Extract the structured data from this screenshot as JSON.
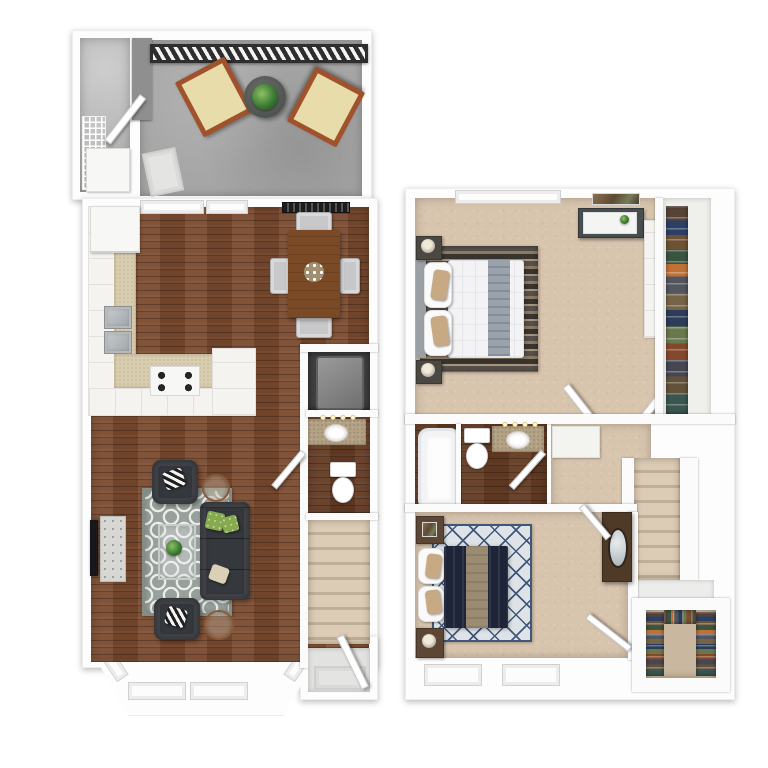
{
  "image_type": "3d-floor-plan-rendering",
  "floors": [
    {
      "label": "first-floor-plan",
      "rooms": [
        "patio",
        "storage-closet",
        "kitchen",
        "dining-area",
        "living-room",
        "utility-closet",
        "powder-room",
        "staircase",
        "entry",
        "bay-window"
      ],
      "furniture": [
        "lounge-chair",
        "lounge-chair",
        "patio-table-with-plant",
        "doormat",
        "refrigerator",
        "double-sink",
        "stove",
        "dining-table",
        "dining-chairs",
        "sofa",
        "armchair",
        "armchair",
        "coffee-table",
        "side-table",
        "side-table",
        "area-rug",
        "tv",
        "media-console",
        "water-heater",
        "pedestal-sink",
        "toilet",
        "front-door"
      ]
    },
    {
      "label": "second-floor-plan",
      "rooms": [
        "master-bedroom",
        "master-closet",
        "bathroom",
        "hallway",
        "staircase",
        "bedroom-2",
        "walk-in-closet"
      ],
      "furniture": [
        "queen-bed",
        "nightstand",
        "nightstand",
        "dresser",
        "wall-art",
        "bathtub",
        "toilet",
        "vanity-sink",
        "bed",
        "nightstand",
        "nightstand",
        "dresser-with-mirror",
        "area-rug",
        "area-rug",
        "hanging-clothes"
      ]
    }
  ],
  "palette": {
    "wall": "#fbfbfb",
    "wood": "#7a4a2e",
    "carpet": "#d8c5ae",
    "concrete": "#a6a6a6",
    "tile": "#d8cdae",
    "granite": "#b2a184",
    "charcoal": "#35383d",
    "rug_gray": "#97a09b",
    "rug_diamond_bg": "#dde3e6",
    "rug_diamond_line": "#41577a",
    "navy": "#1f2539",
    "tan": "#c7a983",
    "runner_tan": "#9b8b72",
    "table_wood": "#7a4a26",
    "chair_gray": "#c8c8cb",
    "railing": "#2e2e2e",
    "chair_frame": "#a0522d",
    "cushion": "#e9dcab",
    "stairs_a": "#dccbb5",
    "stairs_b": "#c0af98"
  }
}
